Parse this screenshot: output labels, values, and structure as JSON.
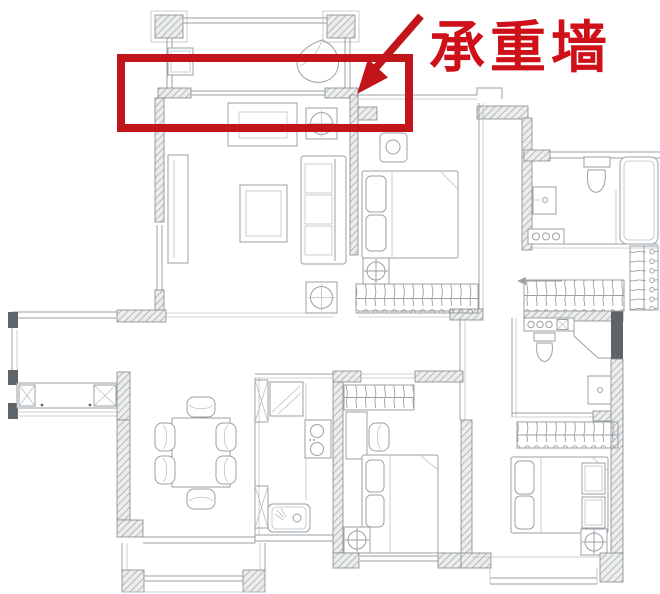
{
  "annotation": {
    "label": "承重墙",
    "shape_color": "#c2151a",
    "text_color": "#ce1118"
  },
  "plan": {
    "background": "#ffffff",
    "line_color": "#9ba0a6",
    "wall_hatch_color": "#a8acb0",
    "features": [
      "balcony-columns",
      "balcony-railing",
      "washing-machine",
      "planter-basin",
      "tv-cabinet",
      "sofa",
      "coffee-table",
      "side-table-lamp",
      "storage-strip",
      "shoe-cabinet",
      "dining-table",
      "dining-chairs",
      "refrigerator",
      "tall-cabinet",
      "kitchen-stove",
      "kitchen-sink",
      "bed",
      "pillows",
      "nightstand",
      "floor-lamp",
      "wardrobe-hangers",
      "toilet",
      "washbasin",
      "bathtub",
      "shower-door",
      "entry-arrow",
      "window"
    ]
  }
}
